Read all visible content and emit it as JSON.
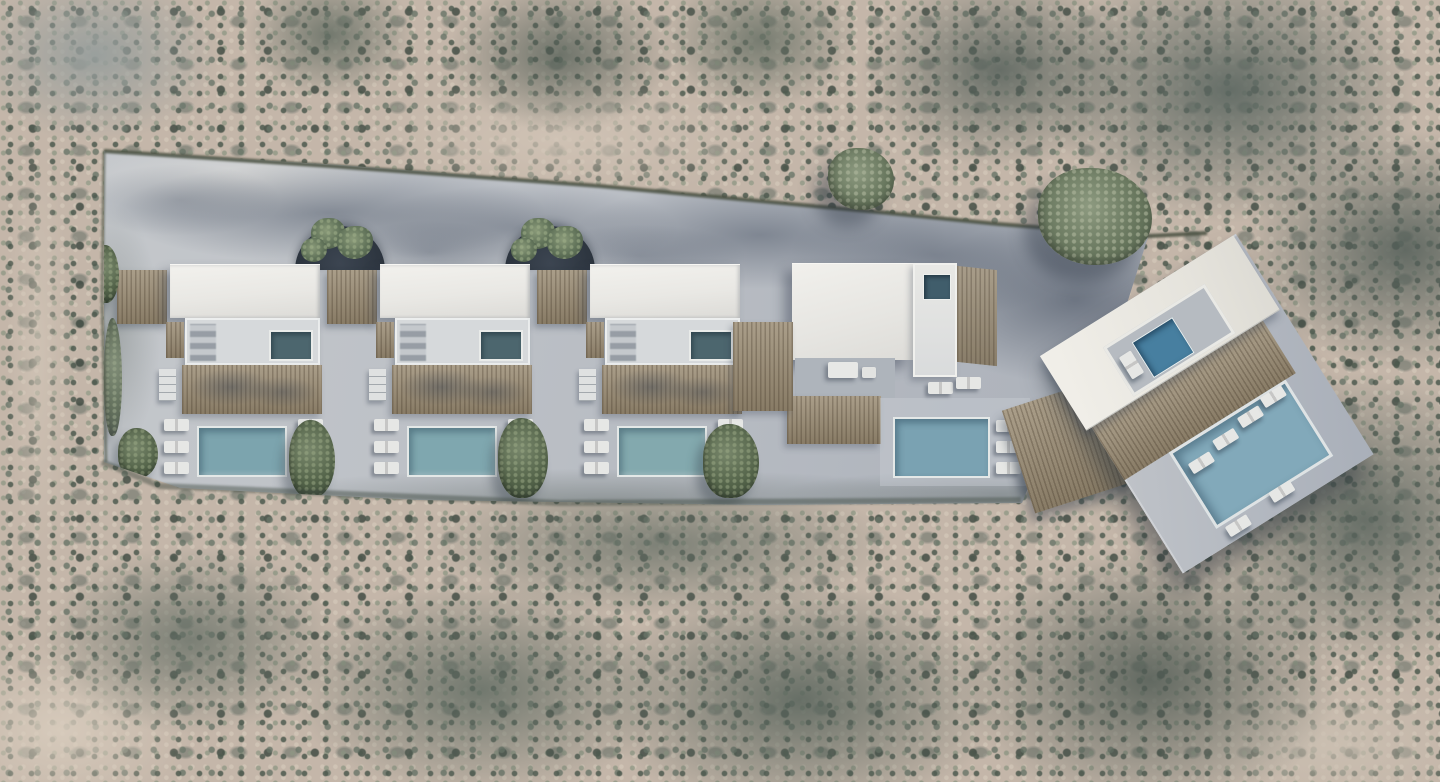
{
  "scene": {
    "description": "Aerial top-down 3D render of a hillside villa complex: three identical pitched-white-roof villas with plunge pools, timber pergolas, slatted wood decks and rectangular blue swimming pools flanked by sun loungers; two arched tree courtyards between the roofs; a fourth flat-roof villa with roof jacuzzi and pool; a fifth rotated villa platform with rooftop courtyard pool and large swimming pool with in-water loungers; all set on a light concrete plot surrounded by dense grey-green Mediterranean scrubland.",
    "environment": {
      "ground_color": "#c4b6a9",
      "foliage_dark": "#49544c",
      "foliage_mid": "#6d7a6c",
      "foliage_light": "#8e9884",
      "sand_light": "#d5c6b5"
    },
    "plot": {
      "concrete_color": "#bcc0c6",
      "concrete_shadow": "#8e95a0",
      "hedge_color": "#4a5142"
    },
    "materials": {
      "roof_white": "#e9e8e4",
      "terrace_white": "#d6d9db",
      "wood_deck": "#9c8e76",
      "wood_dark": "#7e7159",
      "pool_blue": "#7ea5af",
      "pool_blue_deep": "#4e86a6",
      "plunge_teal": "#4c666e",
      "lounger_white": "#e6e7e5",
      "dome_dark": "#2c343e",
      "tree_green": "#66755c"
    },
    "row_villas": [
      {
        "id": "row-villa-1",
        "x": 170,
        "has_dome": true,
        "pool_color": "#7ca4ae"
      },
      {
        "id": "row-villa-2",
        "x": 380,
        "has_dome": true,
        "pool_color": "#7fa7af"
      },
      {
        "id": "row-villa-3",
        "x": 590,
        "has_dome": false,
        "pool_color": "#83a9ae"
      }
    ],
    "villa_4": {
      "pool_color": "#7aa2b2",
      "jacuzzi_color": "#405d6b"
    },
    "right_villa": {
      "rotation_deg": -32,
      "pool_color": "#82a9ba",
      "rooftop_pool_color": "#477fa0"
    },
    "counts": {
      "villas": 5,
      "domed_courtyards": 2,
      "main_pools": 5,
      "plunge_pools": 4,
      "rooftop_pools": 1,
      "loungers_per_row_villa": 6
    }
  }
}
